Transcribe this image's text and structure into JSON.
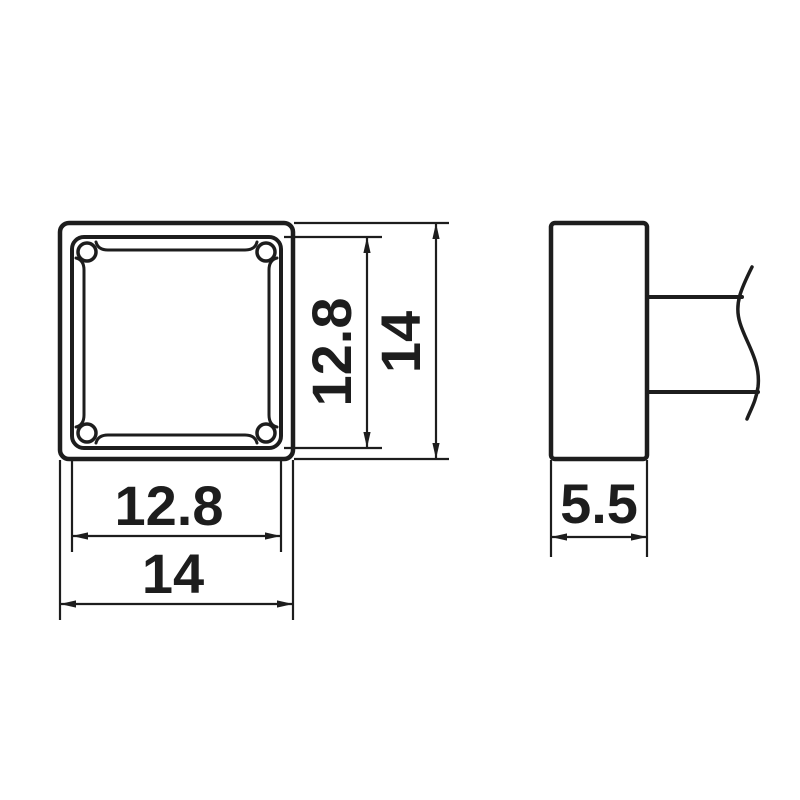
{
  "drawing": {
    "background": "#ffffff",
    "line_color": "#1d1d1d",
    "dimensions": {
      "face_width": {
        "value": "12.8",
        "view": "front",
        "axis": "horizontal"
      },
      "overall_width": {
        "value": "14",
        "view": "front",
        "axis": "horizontal"
      },
      "face_height": {
        "value": "12.8",
        "view": "front",
        "axis": "vertical"
      },
      "overall_height": {
        "value": "14",
        "view": "front",
        "axis": "vertical"
      },
      "depth": {
        "value": "5.5",
        "view": "side",
        "axis": "horizontal"
      }
    }
  }
}
